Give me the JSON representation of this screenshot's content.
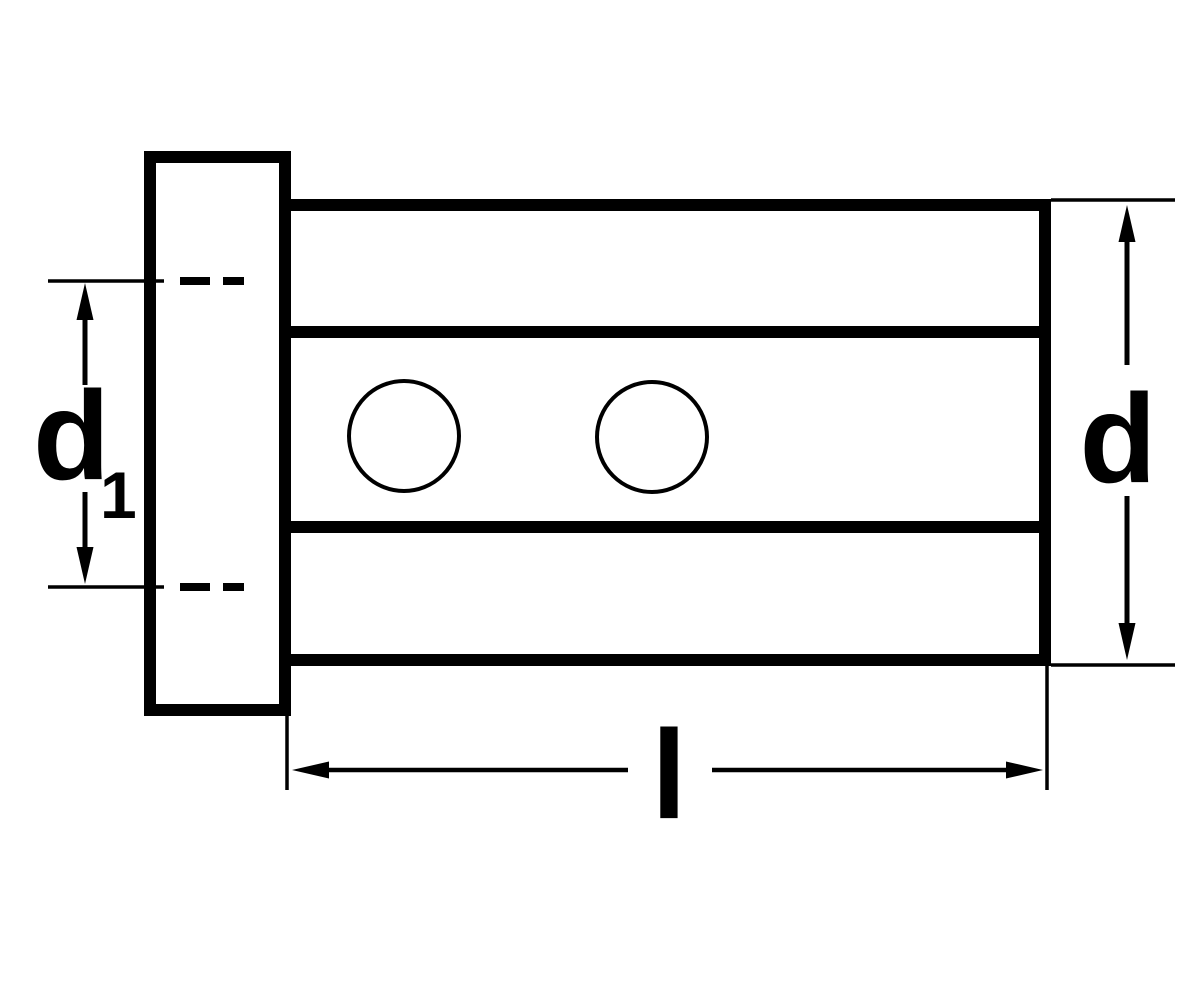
{
  "drawing": {
    "title": "reduction-bushing-side-view",
    "colors": {
      "line": "#000000",
      "background": "#ffffff"
    },
    "dimensions": {
      "bore_diameter": {
        "letter": "d",
        "subscript": "1"
      },
      "outer_diameter": {
        "letter": "d"
      },
      "length": {
        "letter": "l"
      }
    },
    "features": {
      "cross_hole_count": 2
    }
  }
}
